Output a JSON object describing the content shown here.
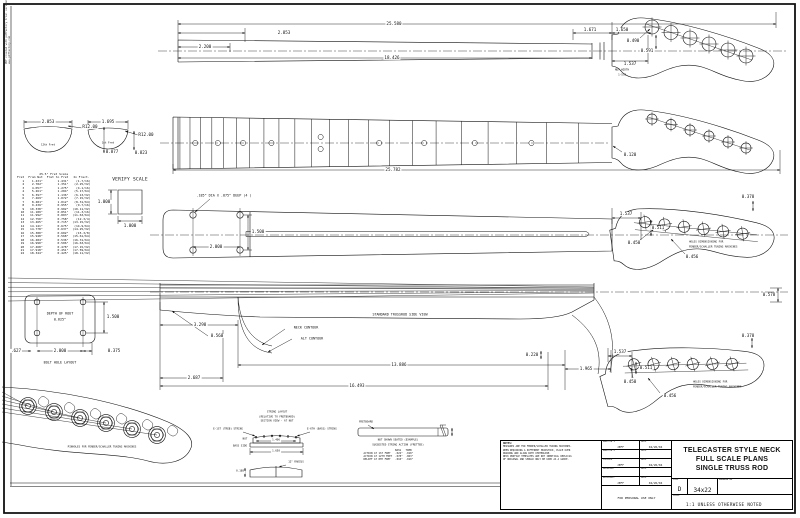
{
  "margin_note": {
    "line1": "PDF created with pdfFactory trial version",
    "line2": "www.pdffactory.com"
  },
  "fret_table": {
    "title": "25.5\" Fret Scale",
    "columns": [
      "Fret",
      "From Nut",
      "Fret to Fret",
      "In Fract."
    ],
    "rows": [
      [
        "1",
        "1.431\"",
        "1.431\"",
        "(1-7/16)"
      ],
      [
        "2",
        "2.782\"",
        "1.351\"",
        "(2-25/32)"
      ],
      [
        "3",
        "4.057\"",
        "1.275\"",
        "(4-1/16)"
      ],
      [
        "4",
        "5.261\"",
        "1.204\"",
        "(5-17/64)"
      ],
      [
        "5",
        "6.397\"",
        "1.136\"",
        "(6-13/32)"
      ],
      [
        "6",
        "7.469\"",
        "1.072\"",
        "(7-15/32)"
      ],
      [
        "7",
        "8.481\"",
        "1.012\"",
        "(8-31/64)"
      ],
      [
        "8",
        "9.436\"",
        "0.955\"",
        "(9-7/16)"
      ],
      [
        "9",
        "10.338\"",
        "0.902\"",
        "(10-11/32)"
      ],
      [
        "10",
        "11.189\"",
        "0.851\"",
        "(11-3/16)"
      ],
      [
        "11",
        "11.992\"",
        "0.803\"",
        "(11-63/64)"
      ],
      [
        "12",
        "12.750\"",
        "0.758\"",
        "(12-3/4)"
      ],
      [
        "13",
        "13.465\"",
        "0.715\"",
        "(13-15/32)"
      ],
      [
        "14",
        "14.141\"",
        "0.675\"",
        "(14-9/64)"
      ],
      [
        "15",
        "14.778\"",
        "0.637\"",
        "(14-25/32)"
      ],
      [
        "16",
        "15.380\"",
        "0.602\"",
        "(15-3/8)"
      ],
      [
        "17",
        "15.948\"",
        "0.568\"",
        "(15-61/64)"
      ],
      [
        "18",
        "16.484\"",
        "0.536\"",
        "(16-31/64)"
      ],
      [
        "19",
        "16.990\"",
        "0.506\"",
        "(16-63/64)"
      ],
      [
        "20",
        "17.468\"",
        "0.478\"",
        "(17-15/32)"
      ],
      [
        "21",
        "17.918\"",
        "0.451\"",
        "(17-59/64)"
      ],
      [
        "22",
        "18.344\"",
        "0.425\"",
        "(18-11/32)"
      ]
    ]
  },
  "verify": {
    "label": "VERIFY SCALE",
    "dim_v": "1.000",
    "dim_h": "1.000"
  },
  "top_view": {
    "overall": "25.580",
    "seg1": "2.853",
    "seg2": "2.200",
    "board": "18.426",
    "a": "1.671",
    "b": "1.650",
    "hole_dia": "0.490",
    "hole_off": "0.591",
    "nut_to_hole": "1.537",
    "nut_note1": "NUT WIDTH",
    "nut_note2": "1-5/8"
  },
  "front_view": {
    "overall": "25.782",
    "edge": "0.120",
    "marker_frets": [
      3,
      5,
      7,
      9,
      12,
      15,
      17,
      19,
      21
    ],
    "s1_width": "2.053",
    "s1_radius": "R12.00",
    "s1_label": "12th Fret",
    "s1_thick": "0.877",
    "s2_width": "1.695",
    "s2_radius": "R12.00",
    "s2_label": "1st Fret",
    "s2_thick": "0.823"
  },
  "back_view": {
    "holes_note": ".185\" DIA X .875\" DEEP (4 )",
    "pat_v": "1.500",
    "pat_h": "2.000",
    "hs_nut": "1.537",
    "hs_off": "0.511",
    "hs_dia": "0.450",
    "hs_sp": "0.456",
    "hs_edge": "0.378",
    "note1": "HOLES DIMENSIONING FOR",
    "note2": "FENDER/SCHALLER TUNING MACHINES"
  },
  "side_view": {
    "trussrod": "STANDARD TRUSSROD SIDE VIEW",
    "contour1": "NECK CONTOUR",
    "contour2": "ALT CONTOUR",
    "d1": "3.298",
    "d2": "0.560",
    "d3": "13.886",
    "d4": "2.687",
    "d5": "16.493",
    "d6": "1.965",
    "d7": "0.220",
    "d8": "0.578",
    "hs_nut": "1.537",
    "hs_off": "0.511",
    "hs_dia": "0.450",
    "hs_sp": "0.456",
    "hs_edge": "0.378",
    "note1": "HOLES DIMENSIONING FOR",
    "note2": "FENDER/SCHALLER TUNING MACHINES"
  },
  "bolt_layout": {
    "line1": "DEPTH OF ROUT",
    "line2": "0.625\"",
    "v": "1.500",
    "h": "2.000",
    "left": ".627",
    "right": "0.375",
    "caption": "BOLT HOLE LAYOUT"
  },
  "tuners_view": {
    "caption": "PINHOLES FOR FENDER/SCHALLER TUNING MACHINES"
  },
  "string_layout": {
    "t1": "STRING LAYOUT",
    "t2": "(RELATIVE TO FRETBOARD)",
    "t3": "SECTION VIEW - AT NUT",
    "left_string": "E-1ST (TREB) STRING",
    "right_string": "E-6TH (BASS) STRING",
    "nut_label": "NUT",
    "side_label": "BASS SIDE",
    "spacing": "1.406",
    "width": "1.650",
    "radius_label": "12\" RADIUS",
    "thick": "0.188"
  },
  "action_detail": {
    "fb": "FRETBOARD",
    "cap1": "NUT SHOWN SEATED (EXAMPLE)",
    "cap2": "SUGGESTED STRING ACTION (FRETTED)",
    "col_bass": "BASS",
    "col_treb": "TREB",
    "rows": [
      [
        "ACTION AT 1ST FRET",
        ".022\"",
        ".018\""
      ],
      [
        "ACTION AT 12TH FRET",
        ".078\"",
        ".063\""
      ],
      [
        "RELIEF AT 8TH FRET",
        ".010\"",
        ".010\""
      ]
    ]
  },
  "title_block": {
    "notes_title": "NOTES:",
    "notes_lines": [
      "MEASURES ARE FOR FENDER/SCHALLER TUNING MACHINES.",
      "WHEN REQUIRING A DIFFERENT HEADSTOCK, PLACE OVER",
      "DRAWING AND ALIGN WITH CENTERLINE.",
      "NECK PROFILE TEMPLATES ARE NOT IDENTICAL REPLICAS",
      "OF ORIGINAL AND SHOULD ONLY BE USED AS A GUIDE."
    ],
    "fields": [
      {
        "label": "DRAFTER 1",
        "value": "JEFF",
        "date_label": "DATE",
        "date": "04/26/04"
      },
      {
        "label": "DRAFTER 2",
        "value": "",
        "date_label": "DATE",
        "date": ""
      },
      {
        "label": "CHECKED",
        "value": "JEFF",
        "date_label": "DATE",
        "date": "04/26/04"
      },
      {
        "label": "APPROVED",
        "value": "",
        "date_label": "DATE",
        "date": ""
      },
      {
        "label": "RELEASED:",
        "value": "JEFF",
        "date_label": "DATE",
        "date": "04/26/04"
      }
    ],
    "personal": "FOR PERSONAL USE ONLY",
    "title1": "TELECASTER STYLE NECK",
    "title2": "FULL SCALE PLANS",
    "title3": "SINGLE TRUSS ROD",
    "size_label": "SIZE",
    "size": "D",
    "sheet": "34x22",
    "drawing_no_label": "DRAWING NO",
    "scale_label": "SCALE",
    "scale": "1:1 UNLESS OTHERWISE NOTED"
  }
}
